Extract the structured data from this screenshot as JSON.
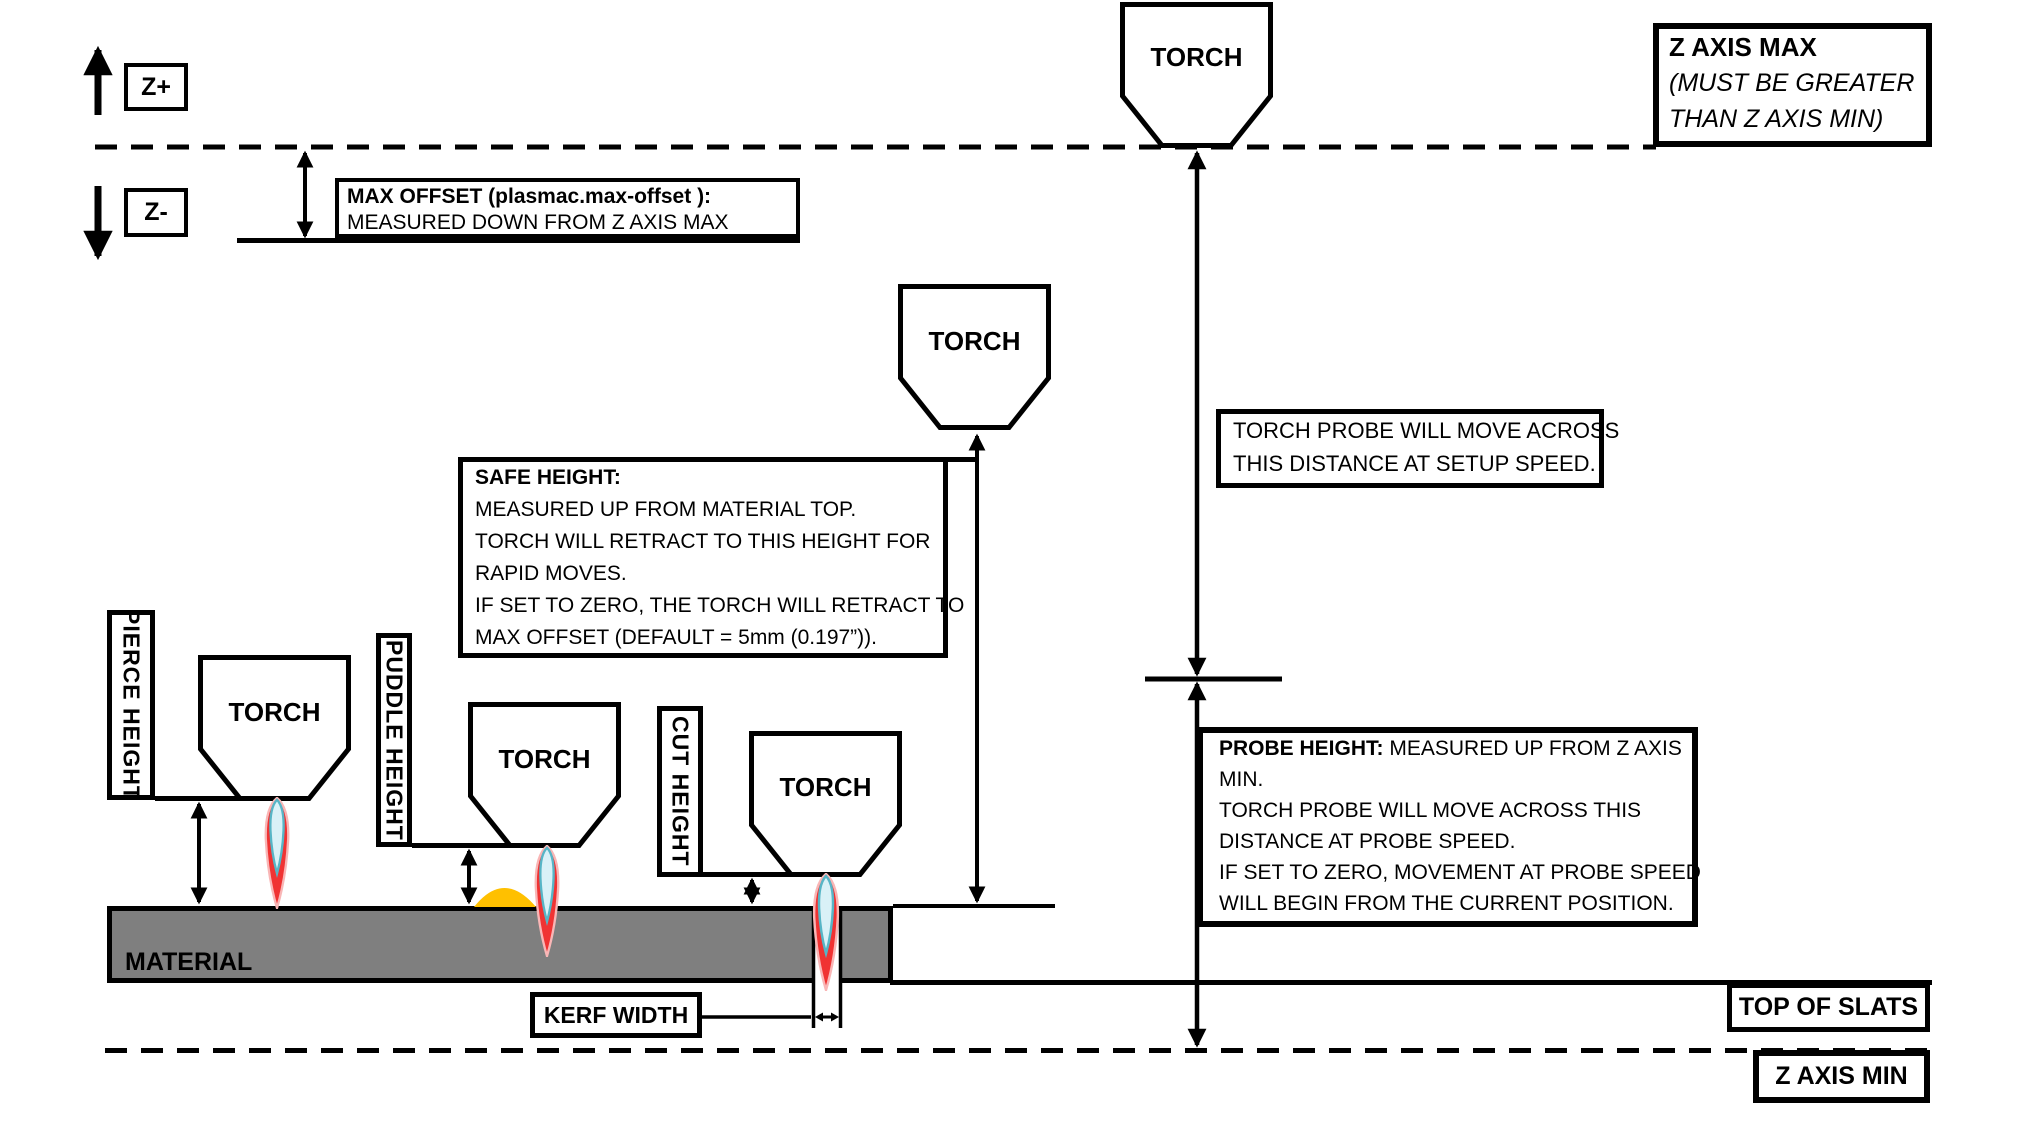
{
  "axis": {
    "z_plus": "Z+",
    "z_minus": "Z-",
    "z_axis_max": {
      "title": "Z AXIS MAX",
      "subtitle_line1": "(MUST BE GREATER",
      "subtitle_line2": "THAN Z AXIS MIN)"
    },
    "z_axis_min": "Z AXIS MIN",
    "top_of_slats": "TOP OF SLATS"
  },
  "max_offset": {
    "title": "MAX OFFSET (plasmac.max-offset ):",
    "line2": "MEASURED DOWN FROM Z AXIS MAX"
  },
  "torch_label": "TORCH",
  "safe_height": {
    "title": "SAFE HEIGHT:",
    "line1": "MEASURED UP FROM MATERIAL TOP.",
    "line2": "TORCH WILL RETRACT TO THIS HEIGHT FOR",
    "line3": "RAPID MOVES.",
    "line4": "IF SET TO ZERO, THE TORCH WILL RETRACT TO",
    "line5": "MAX OFFSET (DEFAULT = 5mm (0.197”))."
  },
  "torch_probe": {
    "line1": "TORCH PROBE WILL MOVE ACROSS",
    "line2": "THIS DISTANCE AT SETUP SPEED."
  },
  "probe_height": {
    "title": "PROBE HEIGHT:",
    "title_rest": " MEASURED UP FROM Z AXIS",
    "line2": "MIN.",
    "line3": "TORCH PROBE WILL MOVE ACROSS THIS",
    "line4": "DISTANCE AT PROBE SPEED.",
    "line5": "IF SET TO ZERO,  MOVEMENT AT PROBE SPEED",
    "line6": "WILL BEGIN FROM THE CURRENT POSITION."
  },
  "measurements": {
    "pierce": "PIERCE HEIGHT",
    "puddle": "PUDDLE HEIGHT",
    "cut": "CUT HEIGHT",
    "kerf": "KERF WIDTH"
  },
  "material_label": "MATERIAL",
  "colors": {
    "line": "#000000",
    "material": "#7f7f7f",
    "puddle": "#ffc000",
    "flame_outer": "#f03333",
    "flame_outer_edge": "#f9b6b6",
    "flame_inner": "#d9f1f7",
    "flame_inner_edge": "#57b5c6"
  }
}
